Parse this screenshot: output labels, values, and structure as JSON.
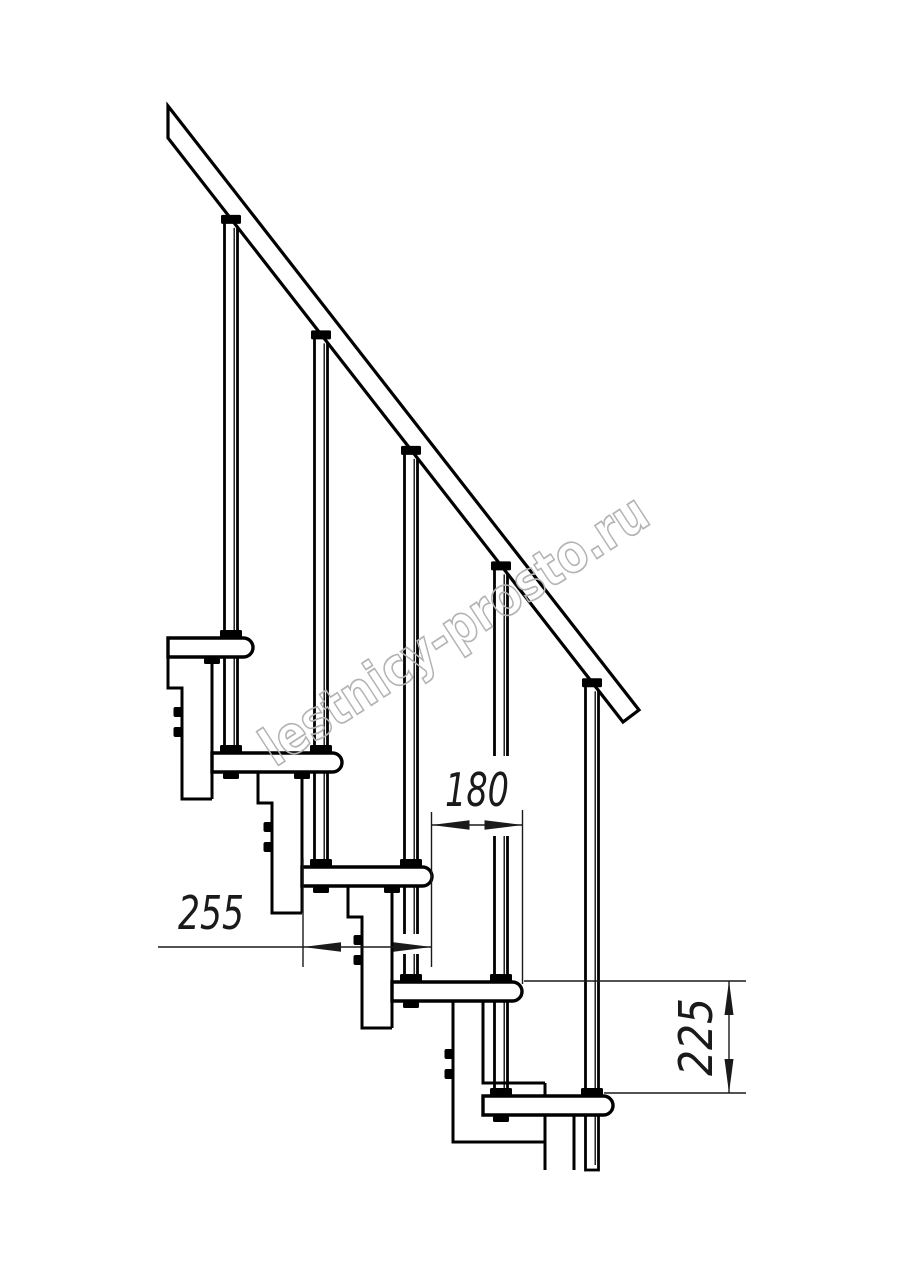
{
  "watermark": {
    "text": "lestnicy-prosto.ru"
  },
  "dimensions": {
    "tread_depth": {
      "value": "255"
    },
    "step_run": {
      "value": "180"
    },
    "step_height": {
      "value": "225"
    }
  },
  "colors": {
    "line": "#000000",
    "dimension": "#1a1a1a",
    "watermark": "#b3b3b3",
    "background": "#ffffff"
  }
}
